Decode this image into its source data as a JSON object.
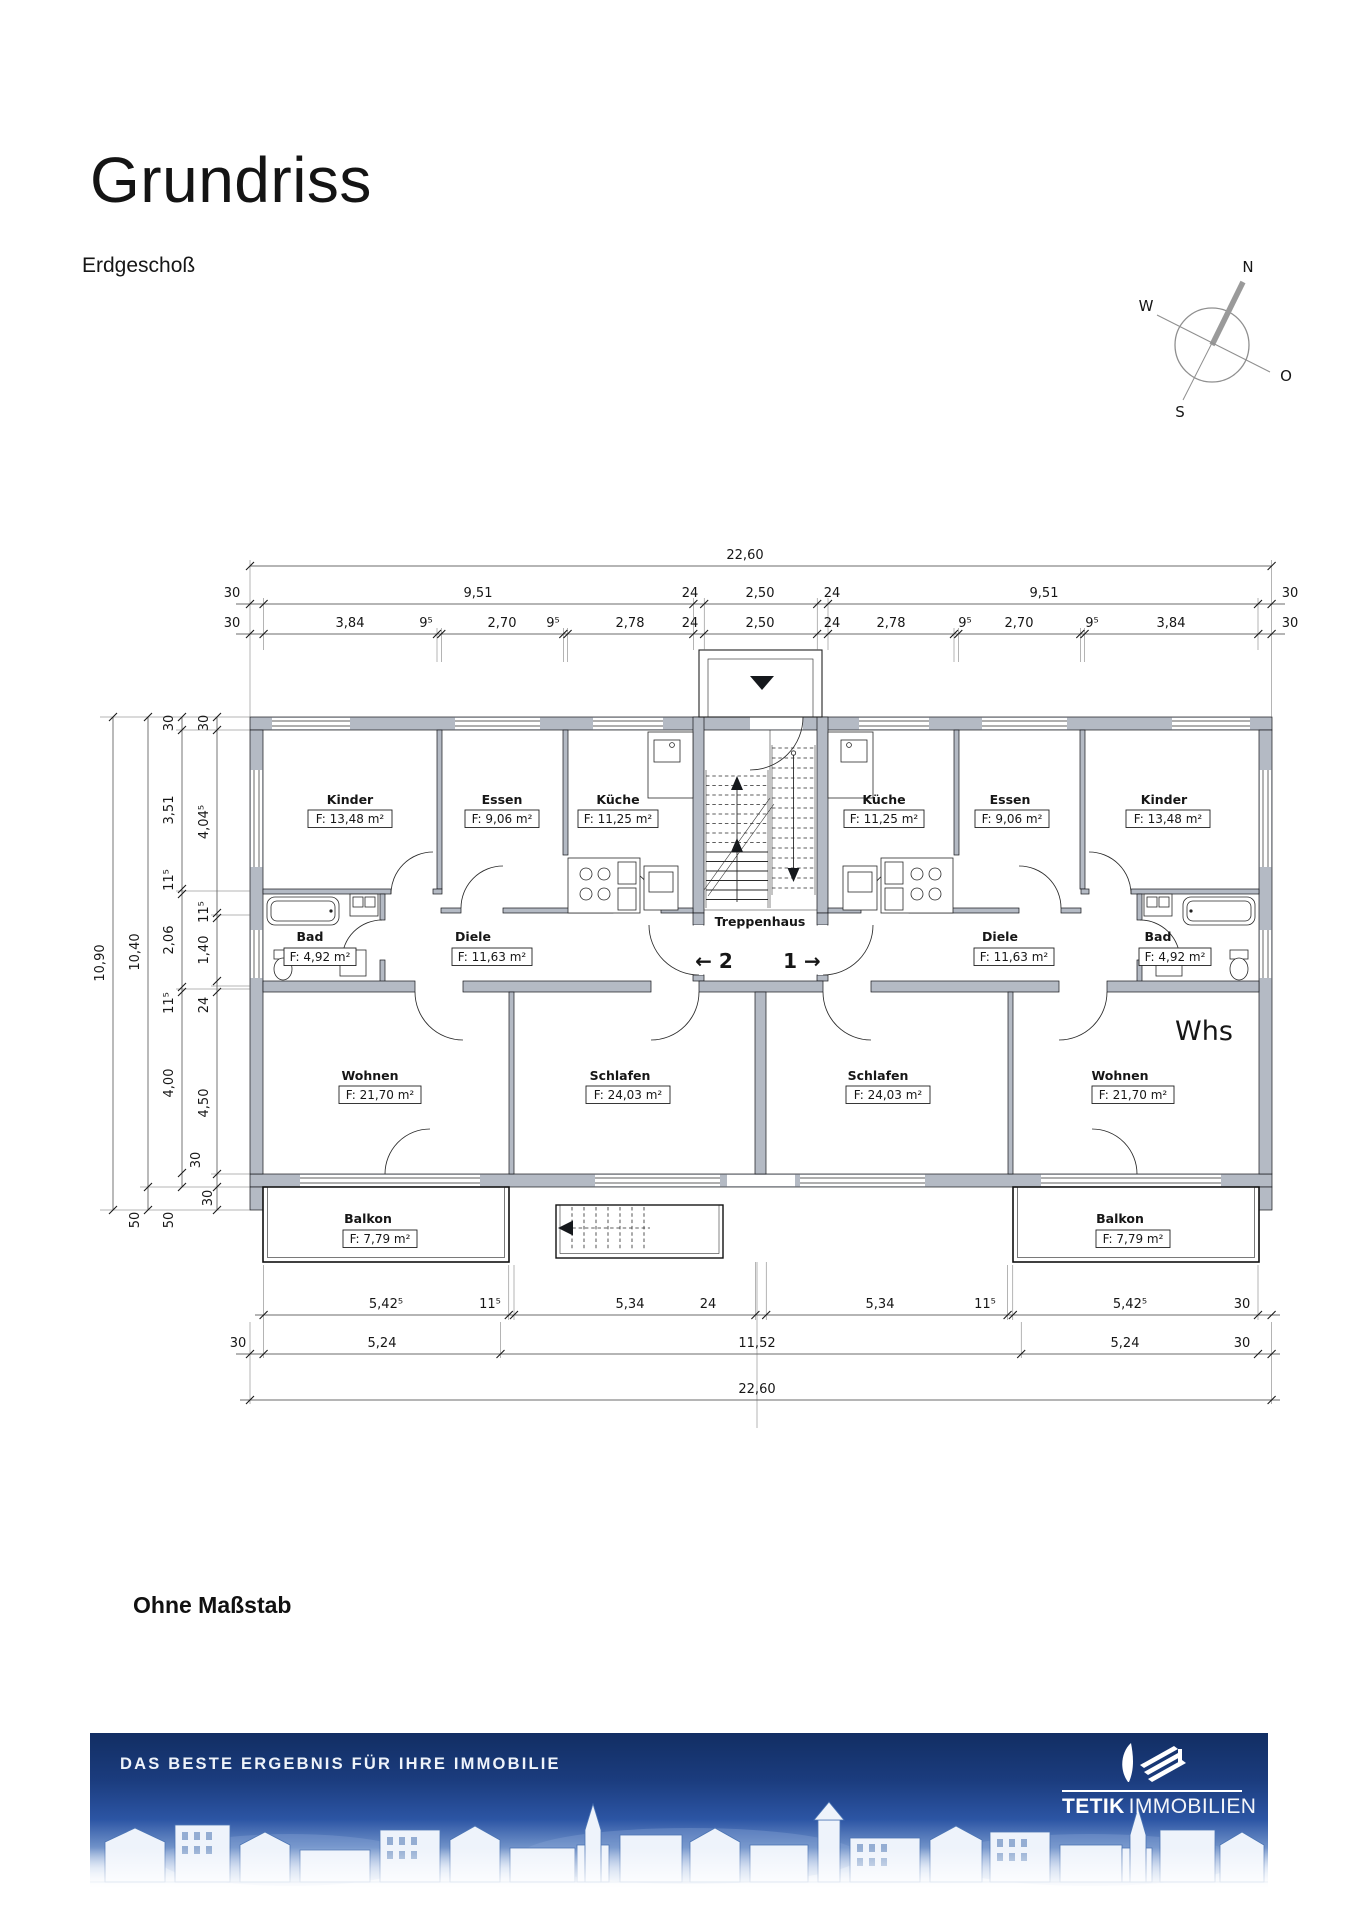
{
  "page": {
    "title": "Grundriss",
    "subtitle": "Erdgeschoß",
    "scale_note": "Ohne Maßstab"
  },
  "compass": {
    "north": "N",
    "south": "S",
    "west": "W",
    "east": "O"
  },
  "plan": {
    "labels": {
      "stairwell": "Treppenhaus",
      "apt_left_no": "← 2",
      "apt_right_no": "1 →",
      "whs": "Whs"
    },
    "rooms": [
      {
        "name": "Kinder",
        "area": "F: 13,48 m²"
      },
      {
        "name": "Essen",
        "area": "F: 9,06 m²"
      },
      {
        "name": "Küche",
        "area": "F: 11,25 m²"
      },
      {
        "name": "Bad",
        "area": "F: 4,92 m²"
      },
      {
        "name": "Diele",
        "area": "F: 11,63 m²"
      },
      {
        "name": "Wohnen",
        "area": "F: 21,70 m²"
      },
      {
        "name": "Schlafen",
        "area": "F: 24,03 m²"
      },
      {
        "name": "Balkon",
        "area": "F: 7,79 m²"
      },
      {
        "name": "Küche",
        "area": "F: 11,25 m²"
      },
      {
        "name": "Essen",
        "area": "F: 9,06 m²"
      },
      {
        "name": "Kinder",
        "area": "F: 13,48 m²"
      },
      {
        "name": "Diele",
        "area": "F: 11,63 m²"
      },
      {
        "name": "Bad",
        "area": "F: 4,92 m²"
      },
      {
        "name": "Schlafen",
        "area": "F: 24,03 m²"
      },
      {
        "name": "Wohnen",
        "area": "F: 21,70 m²"
      },
      {
        "name": "Balkon",
        "area": "F: 7,79 m²"
      }
    ],
    "dims": {
      "top_total": "22,60",
      "top_row2": [
        "30",
        "9,51",
        "24",
        "2,50",
        "24",
        "9,51",
        "30"
      ],
      "top_row3": [
        "30",
        "3,84",
        "9⁵",
        "2,70",
        "9⁵",
        "2,78",
        "24",
        "2,50",
        "24",
        "2,78",
        "9⁵",
        "2,70",
        "9⁵",
        "3,84",
        "30"
      ],
      "left_col1": "10,90",
      "left_col2": "10,40",
      "left_col2b": "50",
      "left_col3": [
        "30",
        "3,51",
        "11⁵",
        "2,06",
        "11⁵",
        "4,00",
        "30",
        "50"
      ],
      "left_col4": [
        "30",
        "4,04⁵",
        "11⁵",
        "1,40",
        "24",
        "4,50",
        "30"
      ],
      "bottom_row1": [
        "5,42⁵",
        "11⁵",
        "5,34",
        "24",
        "5,34",
        "11⁵",
        "5,42⁵",
        "30"
      ],
      "bottom_row2": [
        "30",
        "5,24",
        "11,52",
        "5,24",
        "30"
      ],
      "bottom_total": "22,60"
    }
  },
  "footer": {
    "tagline": "DAS BESTE ERGEBNIS FÜR IHRE IMMOBILIE",
    "brand_bold": "TETIK",
    "brand_light": "IMMOBILIEN"
  }
}
